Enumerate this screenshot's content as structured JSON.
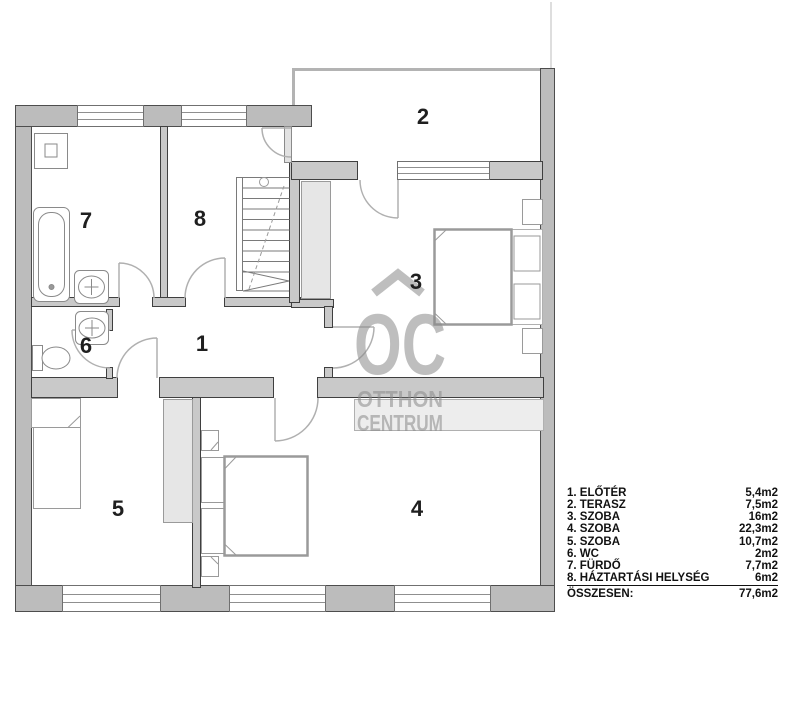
{
  "plan": {
    "room_numbers": [
      "1",
      "2",
      "3",
      "4",
      "5",
      "6",
      "7",
      "8"
    ]
  },
  "watermark": {
    "monogram": "OC",
    "line1": "OTTHON",
    "line2": "CENTRUM"
  },
  "legend": {
    "items": [
      {
        "label": "1. ELŐTÉR",
        "value": "5,4m2"
      },
      {
        "label": "2. TERASZ",
        "value": "7,5m2"
      },
      {
        "label": "3. SZOBA",
        "value": "16m2"
      },
      {
        "label": "4. SZOBA",
        "value": "22,3m2"
      },
      {
        "label": "5. SZOBA",
        "value": "10,7m2"
      },
      {
        "label": "6. WC",
        "value": "2m2"
      },
      {
        "label": "7. FÜRDŐ",
        "value": "7,7m2"
      },
      {
        "label": "8. HÁZTARTÁSI HELYSÉG",
        "value": "6m2"
      }
    ],
    "total_label": "ÖSSZESEN:",
    "total_value": "77,6m2"
  },
  "colors": {
    "wall_fill": "#bcbcbc",
    "interior_wall_fill": "#c9c9c9",
    "watermark_gray": "#8a8a8a",
    "text": "#1f1f1f"
  }
}
